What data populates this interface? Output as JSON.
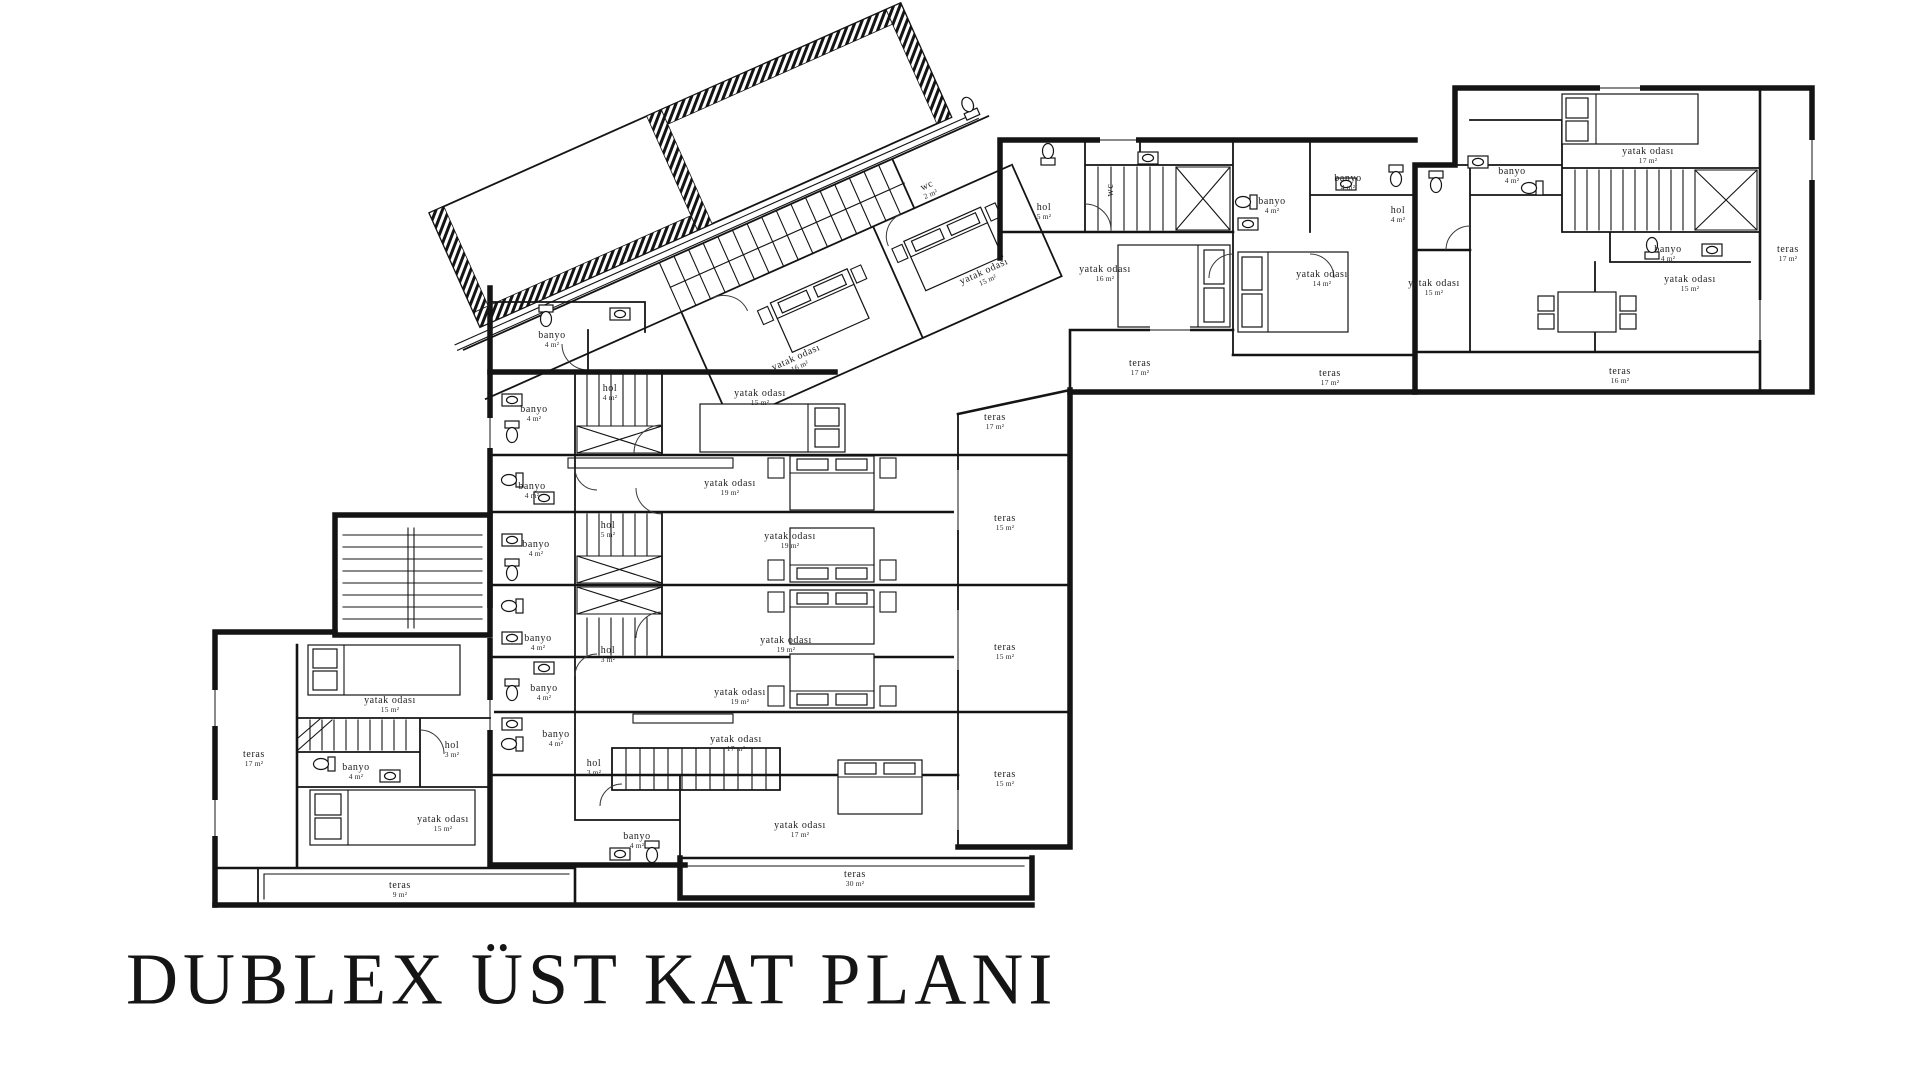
{
  "title": "DUBLEX ÜST KAT PLANI",
  "colors": {
    "ink": "#141414",
    "paper": "#ffffff"
  },
  "plan": {
    "labels": [
      {
        "text": "yatak odası",
        "area": "15 m²",
        "x": 390,
        "y": 703
      },
      {
        "text": "teras",
        "area": "17 m²",
        "x": 254,
        "y": 757
      },
      {
        "text": "hol",
        "area": "3 m²",
        "x": 452,
        "y": 748
      },
      {
        "text": "banyo",
        "area": "4 m²",
        "x": 356,
        "y": 770
      },
      {
        "text": "yatak odası",
        "area": "15 m²",
        "x": 443,
        "y": 822
      },
      {
        "text": "teras",
        "area": "9 m²",
        "x": 400,
        "y": 888
      },
      {
        "text": "hol",
        "area": "4 m²",
        "x": 610,
        "y": 391
      },
      {
        "text": "banyo",
        "area": "4 m²",
        "x": 534,
        "y": 412
      },
      {
        "text": "yatak odası",
        "area": "15 m²",
        "x": 760,
        "y": 396
      },
      {
        "text": "teras",
        "area": "17 m²",
        "x": 995,
        "y": 420
      },
      {
        "text": "banyo",
        "area": "4 m²",
        "x": 532,
        "y": 489
      },
      {
        "text": "yatak odası",
        "area": "19 m²",
        "x": 730,
        "y": 486
      },
      {
        "text": "hol",
        "area": "5 m²",
        "x": 608,
        "y": 528
      },
      {
        "text": "banyo",
        "area": "4 m²",
        "x": 536,
        "y": 547
      },
      {
        "text": "yatak odası",
        "area": "19 m²",
        "x": 790,
        "y": 539
      },
      {
        "text": "teras",
        "area": "15 m²",
        "x": 1005,
        "y": 521
      },
      {
        "text": "banyo",
        "area": "4 m²",
        "x": 538,
        "y": 641
      },
      {
        "text": "hol",
        "area": "3 m²",
        "x": 608,
        "y": 653
      },
      {
        "text": "yatak odası",
        "area": "19 m²",
        "x": 786,
        "y": 643
      },
      {
        "text": "teras",
        "area": "15 m²",
        "x": 1005,
        "y": 650
      },
      {
        "text": "banyo",
        "area": "4 m²",
        "x": 544,
        "y": 691
      },
      {
        "text": "yatak odası",
        "area": "19 m²",
        "x": 740,
        "y": 695
      },
      {
        "text": "banyo",
        "area": "4 m²",
        "x": 556,
        "y": 737
      },
      {
        "text": "hol",
        "area": "3 m²",
        "x": 594,
        "y": 766
      },
      {
        "text": "yatak odası",
        "area": "17 m²",
        "x": 736,
        "y": 742
      },
      {
        "text": "teras",
        "area": "15 m²",
        "x": 1005,
        "y": 777
      },
      {
        "text": "banyo",
        "area": "4 m²",
        "x": 637,
        "y": 839
      },
      {
        "text": "yatak odası",
        "area": "17 m²",
        "x": 800,
        "y": 828
      },
      {
        "text": "teras",
        "area": "30 m²",
        "x": 855,
        "y": 877
      },
      {
        "text": "banyo",
        "area": "4 m²",
        "x": 552,
        "y": 338
      },
      {
        "text": "yatak odası",
        "area": "16 m²",
        "x": 797,
        "y": 360,
        "rot": -24
      },
      {
        "text": "yatak odası",
        "area": "15 m²",
        "x": 985,
        "y": 274,
        "rot": -24
      },
      {
        "text": "wc",
        "area": "2 m²",
        "x": 928,
        "y": 188,
        "rot": -24
      },
      {
        "text": "hol",
        "area": "5 m²",
        "x": 1044,
        "y": 210
      },
      {
        "text": "wc",
        "area": "",
        "x": 1113,
        "y": 190,
        "rot": -90
      },
      {
        "text": "banyo",
        "area": "4 m²",
        "x": 1272,
        "y": 204
      },
      {
        "text": "yatak odası",
        "area": "16 m²",
        "x": 1105,
        "y": 272
      },
      {
        "text": "banyo",
        "area": "4 m²",
        "x": 1348,
        "y": 181
      },
      {
        "text": "hol",
        "area": "4 m²",
        "x": 1398,
        "y": 213
      },
      {
        "text": "yatak odası",
        "area": "14 m²",
        "x": 1322,
        "y": 277
      },
      {
        "text": "teras",
        "area": "17 m²",
        "x": 1140,
        "y": 366
      },
      {
        "text": "teras",
        "area": "17 m²",
        "x": 1330,
        "y": 376
      },
      {
        "text": "yatak odası",
        "area": "17 m²",
        "x": 1648,
        "y": 154
      },
      {
        "text": "banyo",
        "area": "4 m²",
        "x": 1512,
        "y": 174
      },
      {
        "text": "banyo",
        "area": "4 m²",
        "x": 1668,
        "y": 252
      },
      {
        "text": "yatak odası",
        "area": "15 m²",
        "x": 1434,
        "y": 286
      },
      {
        "text": "yatak odası",
        "area": "15 m²",
        "x": 1690,
        "y": 282
      },
      {
        "text": "teras",
        "area": "17 m²",
        "x": 1788,
        "y": 252
      },
      {
        "text": "teras",
        "area": "16 m²",
        "x": 1620,
        "y": 374
      }
    ]
  }
}
